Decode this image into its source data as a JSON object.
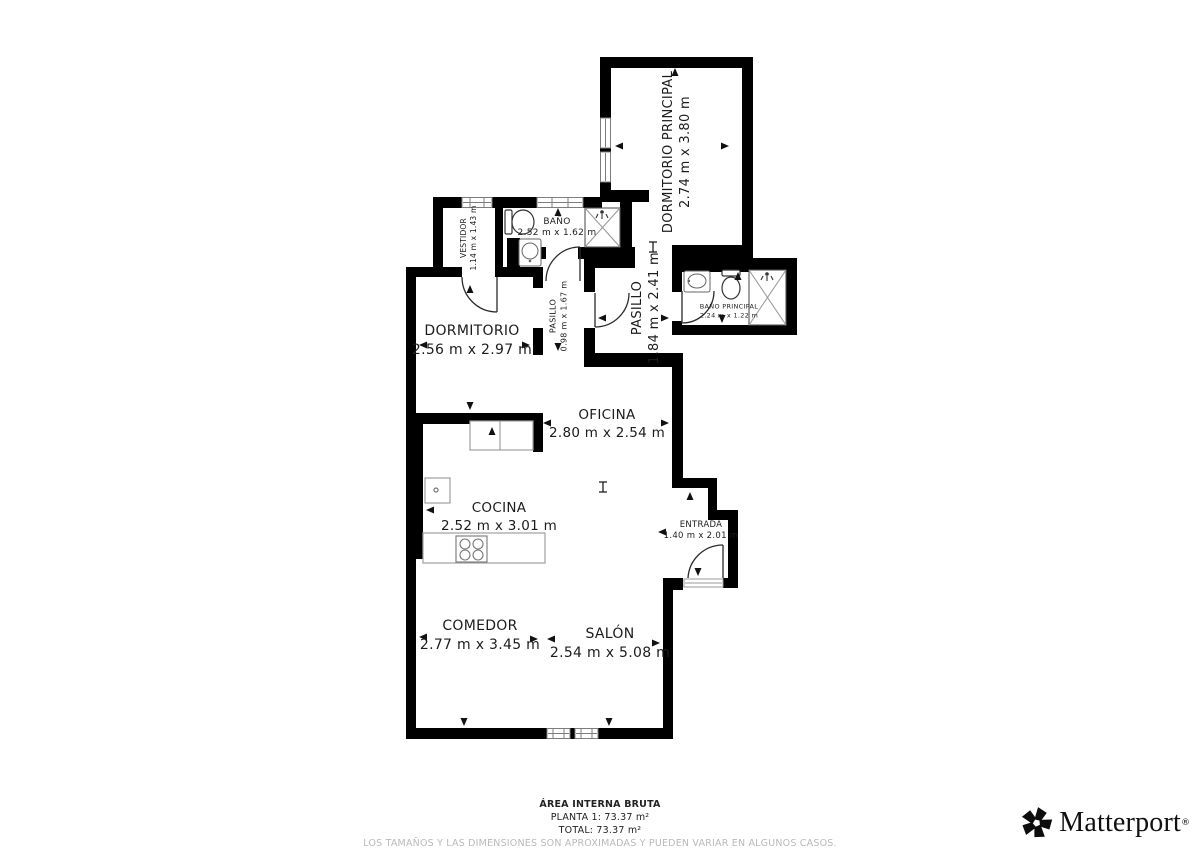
{
  "plan": {
    "rooms": [
      {
        "id": "dormitorio-principal",
        "name": "DORMITORIO PRINCIPAL",
        "dims": "2.74 m x 3.80 m"
      },
      {
        "id": "vestidor",
        "name": "VESTIDOR",
        "dims": "1.14 m x 1.43 m"
      },
      {
        "id": "bano",
        "name": "BAÑO",
        "dims": "2.52 m x 1.62 m"
      },
      {
        "id": "dormitorio",
        "name": "DORMITORIO",
        "dims": "2.56 m x 2.97 m"
      },
      {
        "id": "pasillo-pequeno",
        "name": "PASILLO",
        "dims": "0.98 m x 1.67 m"
      },
      {
        "id": "pasillo",
        "name": "PASILLO",
        "dims": "1.84 m x 2.41 m"
      },
      {
        "id": "bano-principal",
        "name": "BAÑO PRINCIPAL",
        "dims": "2.24 m x 1.22 m"
      },
      {
        "id": "oficina",
        "name": "OFICINA",
        "dims": "2.80 m x 2.54 m"
      },
      {
        "id": "cocina",
        "name": "COCINA",
        "dims": "2.52 m x 3.01 m"
      },
      {
        "id": "entrada",
        "name": "ENTRADA",
        "dims": "1.40 m x 2.01 m"
      },
      {
        "id": "comedor",
        "name": "COMEDOR",
        "dims": "2.77 m x 3.45 m"
      },
      {
        "id": "salon",
        "name": "SALÓN",
        "dims": "2.54 m x 5.08 m"
      }
    ]
  },
  "footer": {
    "area_title": "ÁREA INTERNA BRUTA",
    "planta": "PLANTA 1: 73.37 m²",
    "total": "TOTAL: 73.37 m²",
    "disclaimer": "LOS TAMAÑOS Y LAS DIMENSIONES SON APROXIMADAS Y PUEDEN VARIAR EN ALGUNOS CASOS."
  },
  "brand": {
    "wordmark": "Matterport",
    "registered": "®"
  },
  "colors": {
    "wall": "#000000",
    "label": "#1c1c1c",
    "fixture": "#8f8f8f",
    "disclaimer": "#b9b9b9"
  }
}
